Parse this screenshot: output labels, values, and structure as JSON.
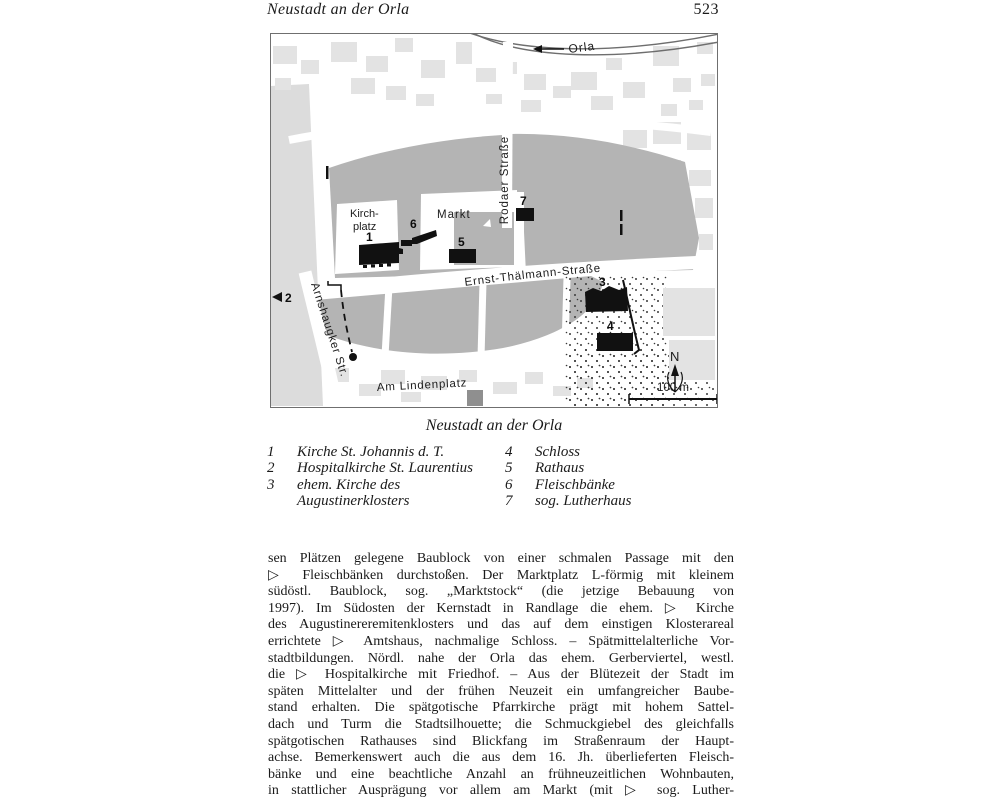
{
  "page": {
    "header_title": "Neustadt an der Orla",
    "page_number": "523"
  },
  "map": {
    "labels": {
      "river": "Orla",
      "rodaer": "Rodaer Straße",
      "markt": "Markt",
      "kirchplatz_line1": "Kirch-",
      "kirchplatz_line2": "platz",
      "ernst": "Ernst-Thälmann-Straße",
      "arnshaugker": "Arnshaugker Str.",
      "lindenplatz": "Am Lindenplatz",
      "north": "N",
      "scale": "100 m"
    },
    "markers": {
      "m1": "1",
      "m2": "2",
      "m3": "3",
      "m4": "4",
      "m5": "5",
      "m6": "6",
      "m7": "7"
    },
    "colors": {
      "core_block": "#b4b4b4",
      "outer_building": "#e3e3e3",
      "left_strip": "#dcdcdc",
      "dark_building": "#8f8f8f",
      "black_building": "#111111"
    }
  },
  "caption": "Neustadt an der Orla",
  "legend": {
    "left": [
      {
        "num": "1",
        "text": "Kirche St. Johannis d. T."
      },
      {
        "num": "2",
        "text": "Hospitalkirche St. Laurentius"
      },
      {
        "num": "3",
        "text": "ehem. Kirche des"
      },
      {
        "num": "",
        "text": "Augustinerklosters"
      }
    ],
    "right": [
      {
        "num": "4",
        "text": "Schloss"
      },
      {
        "num": "5",
        "text": "Rathaus"
      },
      {
        "num": "6",
        "text": "Fleischbänke"
      },
      {
        "num": "7",
        "text": "sog. Lutherhaus"
      }
    ]
  },
  "body": {
    "lines": [
      "sen Plätzen gelegene Baublock von einer schmalen Passage mit den",
      "▷ Fleischbänken durchstoßen. Der Marktplatz L-förmig mit kleinem",
      "südöstl. Baublock, sog. „Marktstock“ (die jetzige Bebauung von",
      "1997). Im Südosten der Kernstadt in Randlage die ehem. ▷ Kirche",
      "des Augustinereremitenklosters und das auf dem einstigen Klosterareal",
      "errichtete ▷ Amtshaus, nachmalige Schloss. – Spätmittelalterliche Vor-",
      "stadtbildungen. Nördl. nahe der Orla das ehem. Gerberviertel, westl.",
      "die ▷ Hospitalkirche mit Friedhof. – Aus der Blütezeit der Stadt im",
      "späten Mittelalter und der frühen Neuzeit ein umfangreicher Baube-",
      "stand erhalten. Die spätgotische Pfarrkirche prägt mit hohem Sattel-",
      "dach und Turm die Stadtsilhouette; die Schmuckgiebel des gleichfalls",
      "spätgotischen Rathauses sind Blickfang im Straßenraum der Haupt-",
      "achse. Bemerkenswert auch die aus dem 16. Jh. überlieferten Fleisch-",
      "bänke und eine beachtliche Anzahl an frühneuzeitlichen Wohnbauten,",
      "in stattlicher Ausprägung vor allem am Markt (mit ▷ sog. Luther-"
    ]
  }
}
